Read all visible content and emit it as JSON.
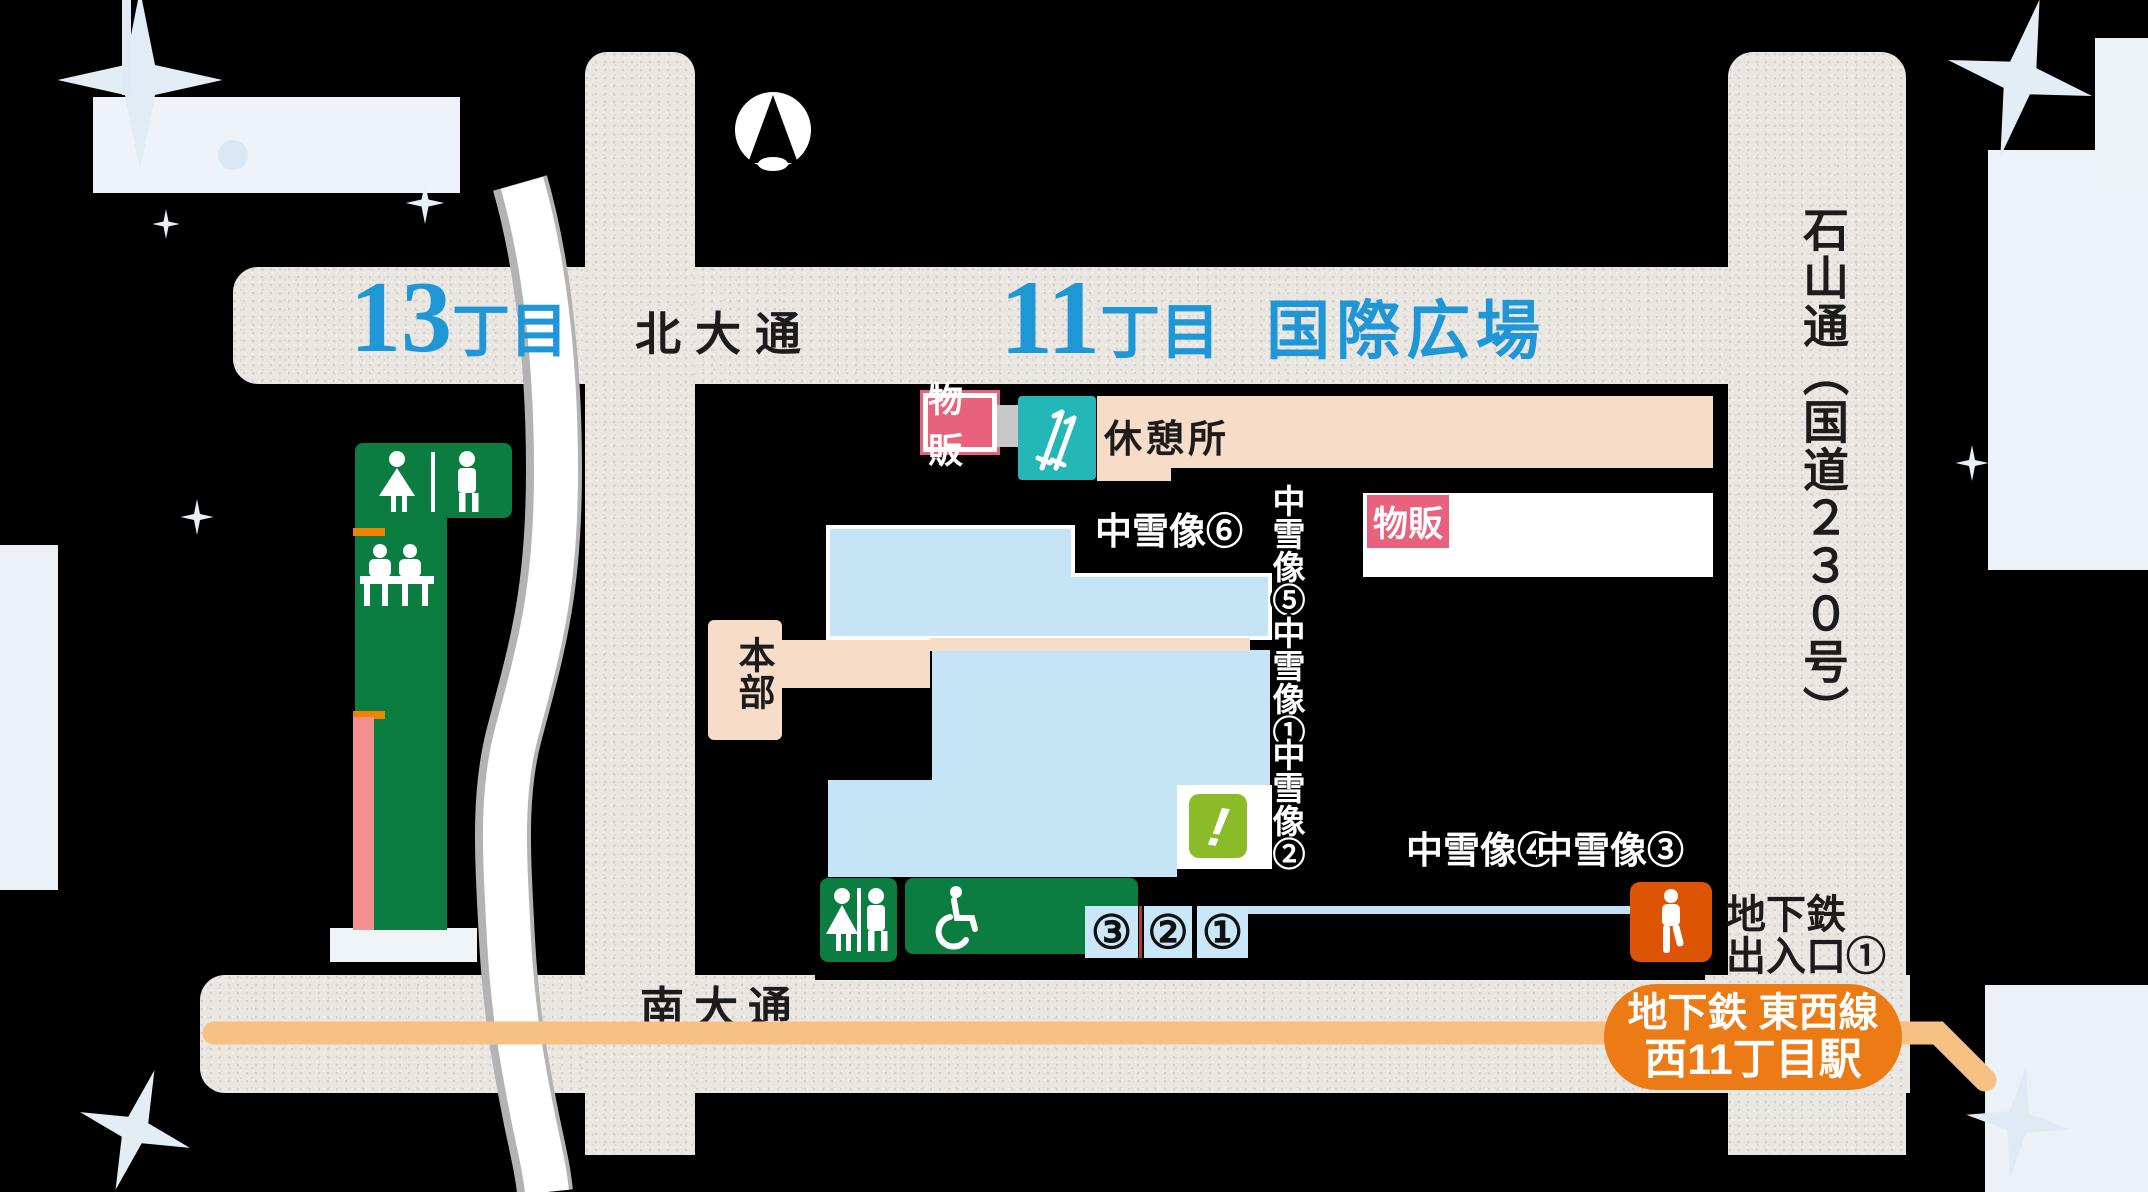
{
  "titles": {
    "block13": {
      "number": "13",
      "unit": "丁目"
    },
    "block11": {
      "number": "11",
      "unit": "丁目",
      "name": "国際広場"
    }
  },
  "roads": {
    "north": "北大通",
    "south": "南大通",
    "east_vertical": "石山通（国道２３０号）"
  },
  "facilities": {
    "sales_badge_1": "物販",
    "sales_badge_2": "物販",
    "rest_area": "休憩所",
    "headquarters": "本部",
    "alert_mark": "!"
  },
  "snow_sculptures": {
    "s6": "中雪像⑥",
    "s5": "中雪像⑤",
    "s1": "中雪像①",
    "s2": "中雪像②",
    "s4": "中雪像④",
    "s3": "中雪像③"
  },
  "gates": [
    "③",
    "②",
    "①"
  ],
  "subway": {
    "exit_line1": "地下鉄",
    "exit_line2": "出入口①",
    "station_line1": "地下鉄 東西線",
    "station_line2": "西11丁目駅"
  },
  "icons": {
    "compass": "north-arrow",
    "toilet": "men-women-restroom",
    "bench": "rest-bench-people",
    "ski": "ski-poles",
    "wheelchair": "wheelchair-access",
    "person": "standing-person",
    "sparkle": "snow-sparkle"
  },
  "colors": {
    "road": "#eae6e2",
    "title_blue": "#1f96d6",
    "badge_pink": "#e8617d",
    "peach": "#f7dcc8",
    "teal": "#25b6b8",
    "light_blue": "#c5e4f6",
    "green": "#0b7d40",
    "alert_green": "#8cbb2a",
    "exit_orange": "#dc5404",
    "station_orange": "#ec7a15",
    "subway_line_orange": "#f6c183",
    "pink_strip": "#f2908d",
    "orange_tick": "#f08300"
  }
}
